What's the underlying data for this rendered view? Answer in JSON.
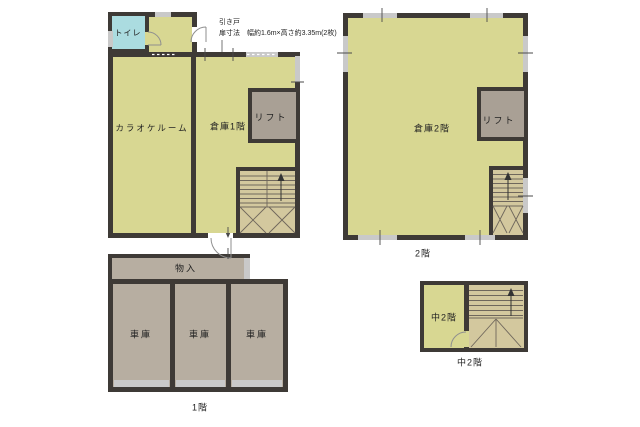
{
  "colors": {
    "canvas": "#ffffff",
    "wall": "#3e3a36",
    "room": "#d8d792",
    "stair": "#d3c89e",
    "service": "#a9a095",
    "garage": "#b7aea1",
    "toilet": "#abdce0",
    "window": "#c9c9c9",
    "text": "#222222"
  },
  "plans": {
    "ground_main": {
      "rooms": {
        "toilet": "トイレ",
        "karaoke": "カラオケルーム",
        "warehouse": "倉庫1階",
        "lift": "リフト"
      },
      "annotation": {
        "line1": "引き戸",
        "line2": "扉寸法　幅約1.6m×高さ約3.35m(2枚)"
      }
    },
    "second_floor": {
      "caption": "2階",
      "rooms": {
        "warehouse": "倉庫2階",
        "lift": "リフト"
      }
    },
    "first_floor_garage": {
      "caption": "1階",
      "rooms": {
        "storage": "物入",
        "garage_left": "車庫",
        "garage_center": "車庫",
        "garage_right": "車庫"
      }
    },
    "mezzanine": {
      "caption": "中2階",
      "rooms": {
        "mezzanine": "中2階"
      }
    }
  }
}
